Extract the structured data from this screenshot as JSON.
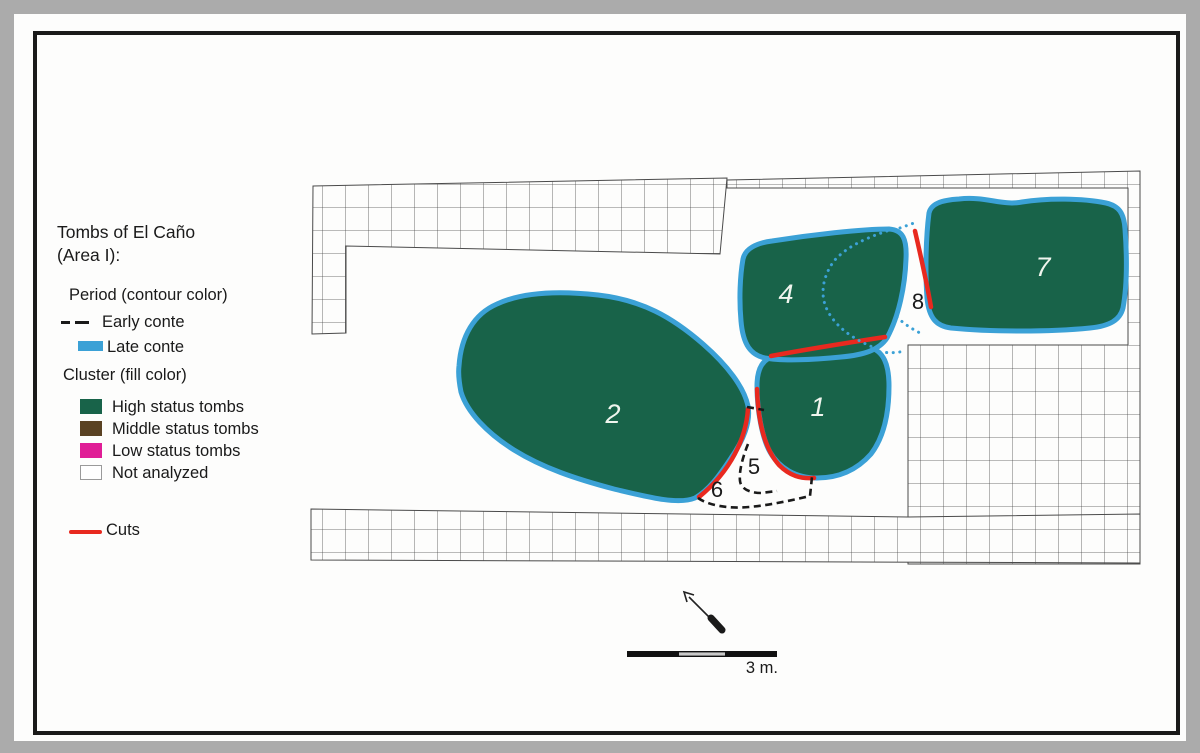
{
  "title": {
    "line1": "Tombs of El Caño",
    "line2": "(Area I):"
  },
  "legend": {
    "period_heading": "Period (contour color)",
    "period_items": [
      {
        "label": "Early conte",
        "marker": "dashed-black-line"
      },
      {
        "label": "Late conte",
        "marker": "solid-blue-line"
      }
    ],
    "cluster_heading": "Cluster (fill color)",
    "cluster_items": [
      {
        "label": "High status tombs",
        "color_key": "high_status_green"
      },
      {
        "label": "Middle status tombs",
        "color_key": "middle_status_brown"
      },
      {
        "label": "Low status tombs",
        "color_key": "low_status_magenta"
      },
      {
        "label": "Not analyzed",
        "color_key": "not_analyzed_white"
      }
    ],
    "cuts_label": "Cuts"
  },
  "map": {
    "tomb_labels": [
      {
        "id": "tomb-2",
        "text": "2"
      },
      {
        "id": "tomb-1",
        "text": "1"
      },
      {
        "id": "tomb-4",
        "text": "4"
      },
      {
        "id": "tomb-7",
        "text": "7"
      }
    ],
    "cut_labels": [
      {
        "id": "label-8",
        "text": "8"
      },
      {
        "id": "label-5",
        "text": "5"
      },
      {
        "id": "label-6",
        "text": "6"
      }
    ],
    "scale_label": "3 m."
  },
  "colors": {
    "page_bg": "#ababab",
    "frame": "#1a1a1a",
    "text": "#1a1a1a",
    "grid_line": "#4a4a4a",
    "late_conte_blue": "#3ba1d6",
    "early_conte_black": "#1a1a1a",
    "high_status_green": "#186349",
    "middle_status_brown": "#5a4223",
    "low_status_magenta": "#e01d96",
    "not_analyzed_white": "#ffffff",
    "cuts_red": "#e8291f",
    "label_white": "#f0f5ee"
  }
}
